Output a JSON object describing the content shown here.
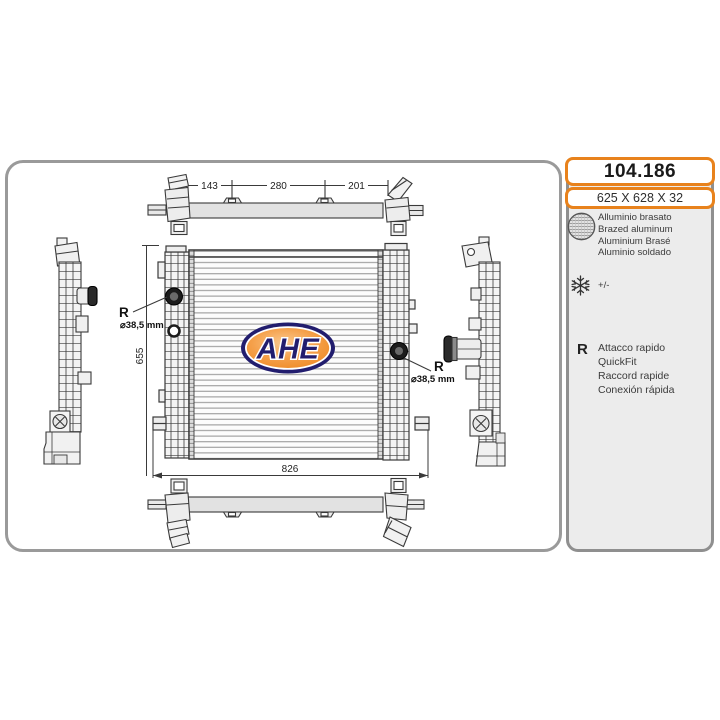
{
  "header": {
    "part_number": "104.186",
    "size": "625 X 628 X 32"
  },
  "info_panel": {
    "material": {
      "icon": "brazed-aluminum-mesh-icon",
      "lines": [
        "Alluminio brasato",
        "Brazed aluminum",
        "Aluminium Brasé",
        "Aluminio soldado"
      ]
    },
    "tolerance": {
      "icon": "snowflake-icon",
      "label": "+/-"
    },
    "quickfit": {
      "symbol": "R",
      "lines": [
        "Attacco rapido",
        "QuickFit",
        "Raccord rapide",
        "Conexión rápida"
      ]
    }
  },
  "diagram": {
    "logo": "AHE",
    "dims": {
      "top_left": "143",
      "top_mid": "280",
      "top_right": "201",
      "height": "655",
      "width": "826"
    },
    "ports": {
      "left": {
        "symbol": "R",
        "diameter": "⌀38,5 mm"
      },
      "right": {
        "symbol": "R",
        "diameter": "⌀38,5 mm"
      }
    }
  },
  "colors": {
    "accent_orange": "#e8821c",
    "logo_navy": "#221d6e",
    "logo_orange": "#ee8a25",
    "panel_gray": "#ececec",
    "border_gray": "#9a9a9a",
    "line_dark": "#3a3a3a"
  }
}
